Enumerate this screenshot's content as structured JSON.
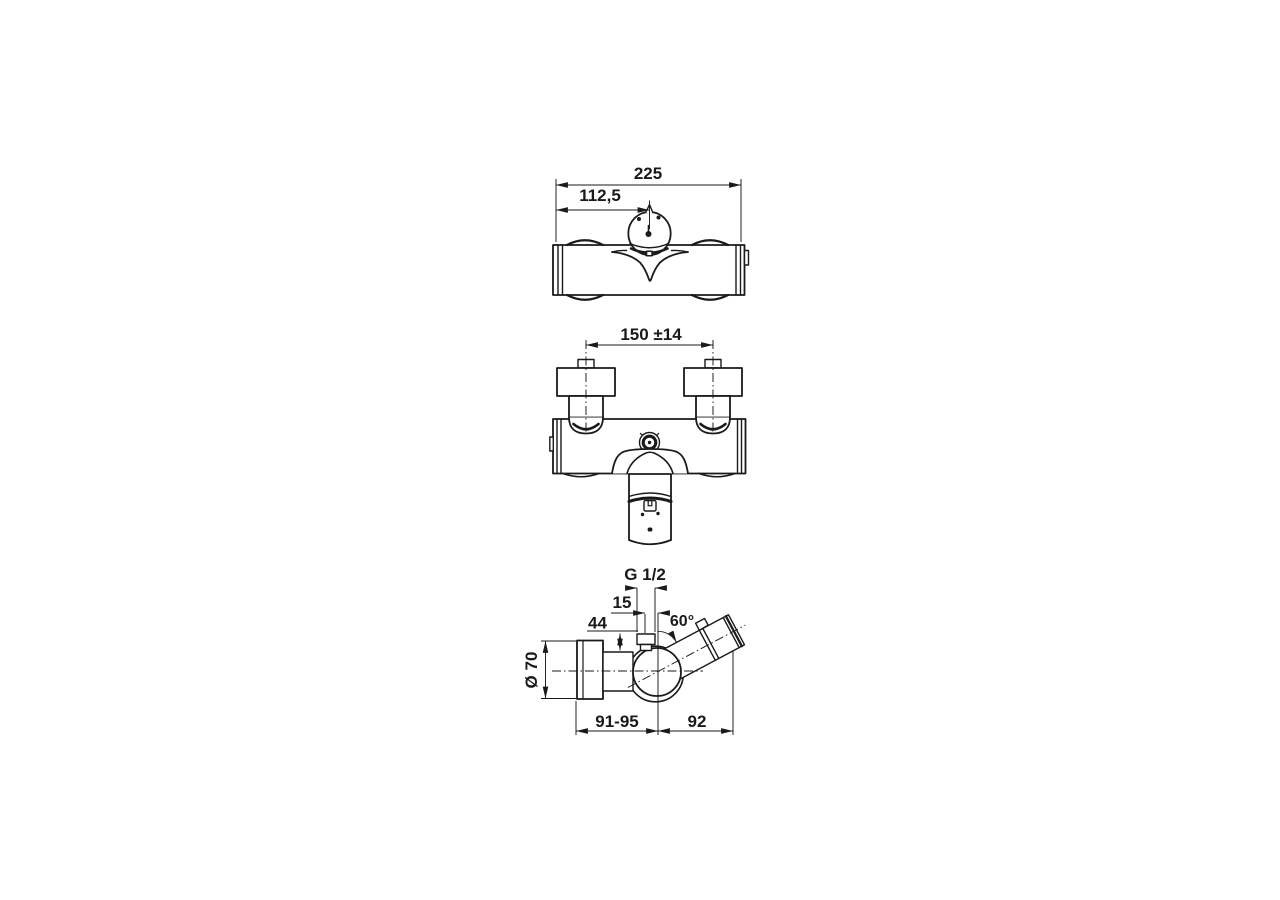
{
  "views": {
    "top": {
      "overall_width": "225",
      "center_offset": "112,5"
    },
    "front": {
      "connection_distance": "150 ±14"
    },
    "side": {
      "thread": "G 1/2",
      "offset": "15",
      "nipple_height": "44",
      "outlet_angle": "60°",
      "knob_diameter": "Ø 70",
      "depth_body": "91-95",
      "depth_outlet": "92"
    }
  },
  "colors": {
    "line": "#1a1a1a",
    "background": "#ffffff"
  }
}
